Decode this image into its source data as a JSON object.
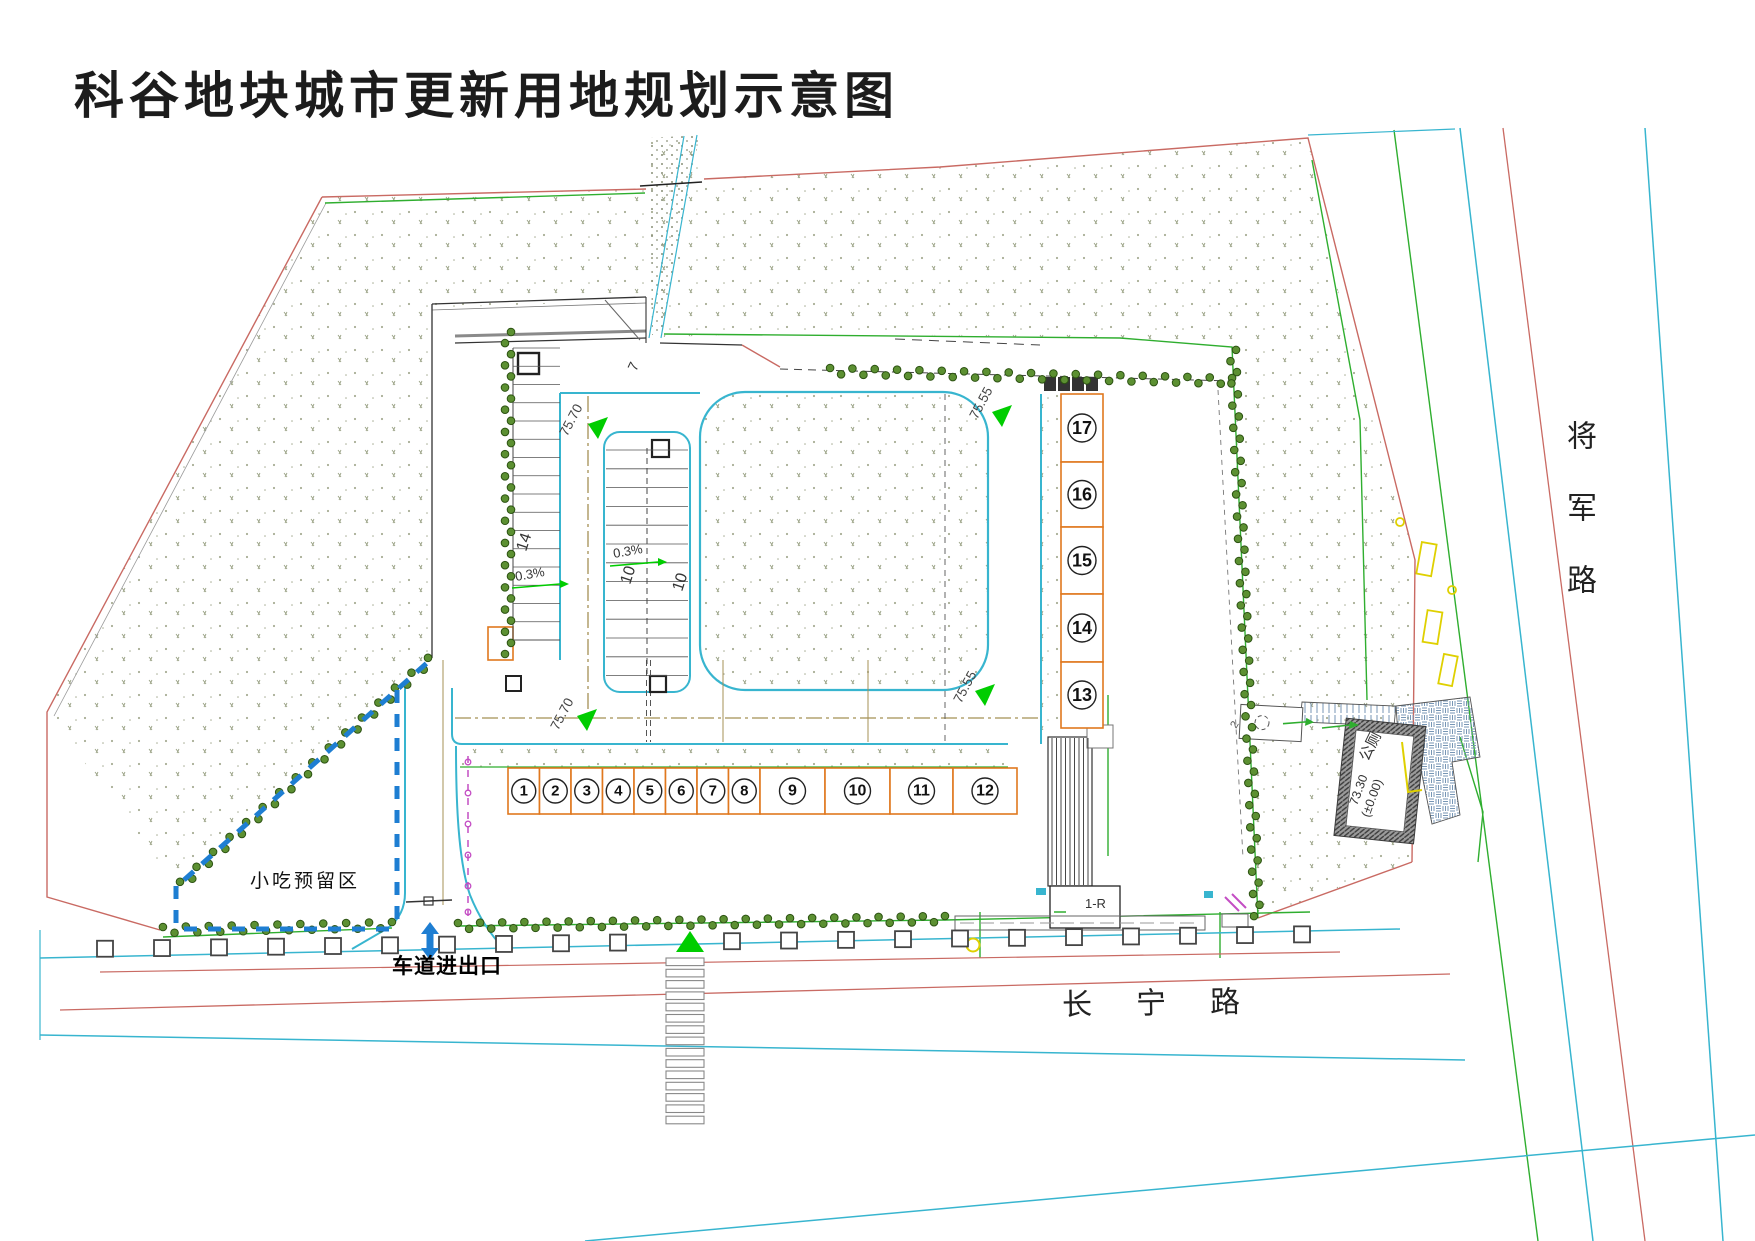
{
  "title": "科谷地块城市更新用地规划示意图",
  "roads": {
    "east": "将军路",
    "south": "长宁路"
  },
  "labels": {
    "snack_area": "小吃预留区",
    "entrance": "车道进出口",
    "building": "1-R",
    "toilet": "公厕",
    "toilet_elevation": "73.30",
    "toilet_elevation_datum": "(±0.00)",
    "ramp_count": "7",
    "plaza_note": "2"
  },
  "units": {
    "row": [
      "1",
      "2",
      "3",
      "4",
      "5",
      "6",
      "7",
      "8",
      "9",
      "10",
      "11",
      "12"
    ],
    "column": [
      "17",
      "16",
      "15",
      "14",
      "13"
    ]
  },
  "elevation_markers": [
    {
      "value": "75.70",
      "loc": "west-aisle"
    },
    {
      "value": "75.70",
      "loc": "south-aisle"
    },
    {
      "value": "75.55",
      "loc": "east-aisle-top"
    },
    {
      "value": "75.55",
      "loc": "east-aisle-bottom"
    }
  ],
  "slope_labels": [
    "0.3%",
    "0.3%"
  ],
  "stall_counts": [
    "14",
    "10",
    "10"
  ],
  "colors": {
    "boundary_red": "#c96a63",
    "cyan": "#38b5cf",
    "green": "#2fae2f",
    "bright_green": "#00cd00",
    "hedge_fill": "#5c9032",
    "hedge_edge": "#2c5212",
    "orange": "#e0781e",
    "blue_dash": "#1e7ed2",
    "magenta": "#c44ec4",
    "yellow": "#dfd000",
    "tan": "#a59055",
    "stipple": "#99a184",
    "line_dark": "#333333",
    "pave_blue": "#7796b5"
  }
}
